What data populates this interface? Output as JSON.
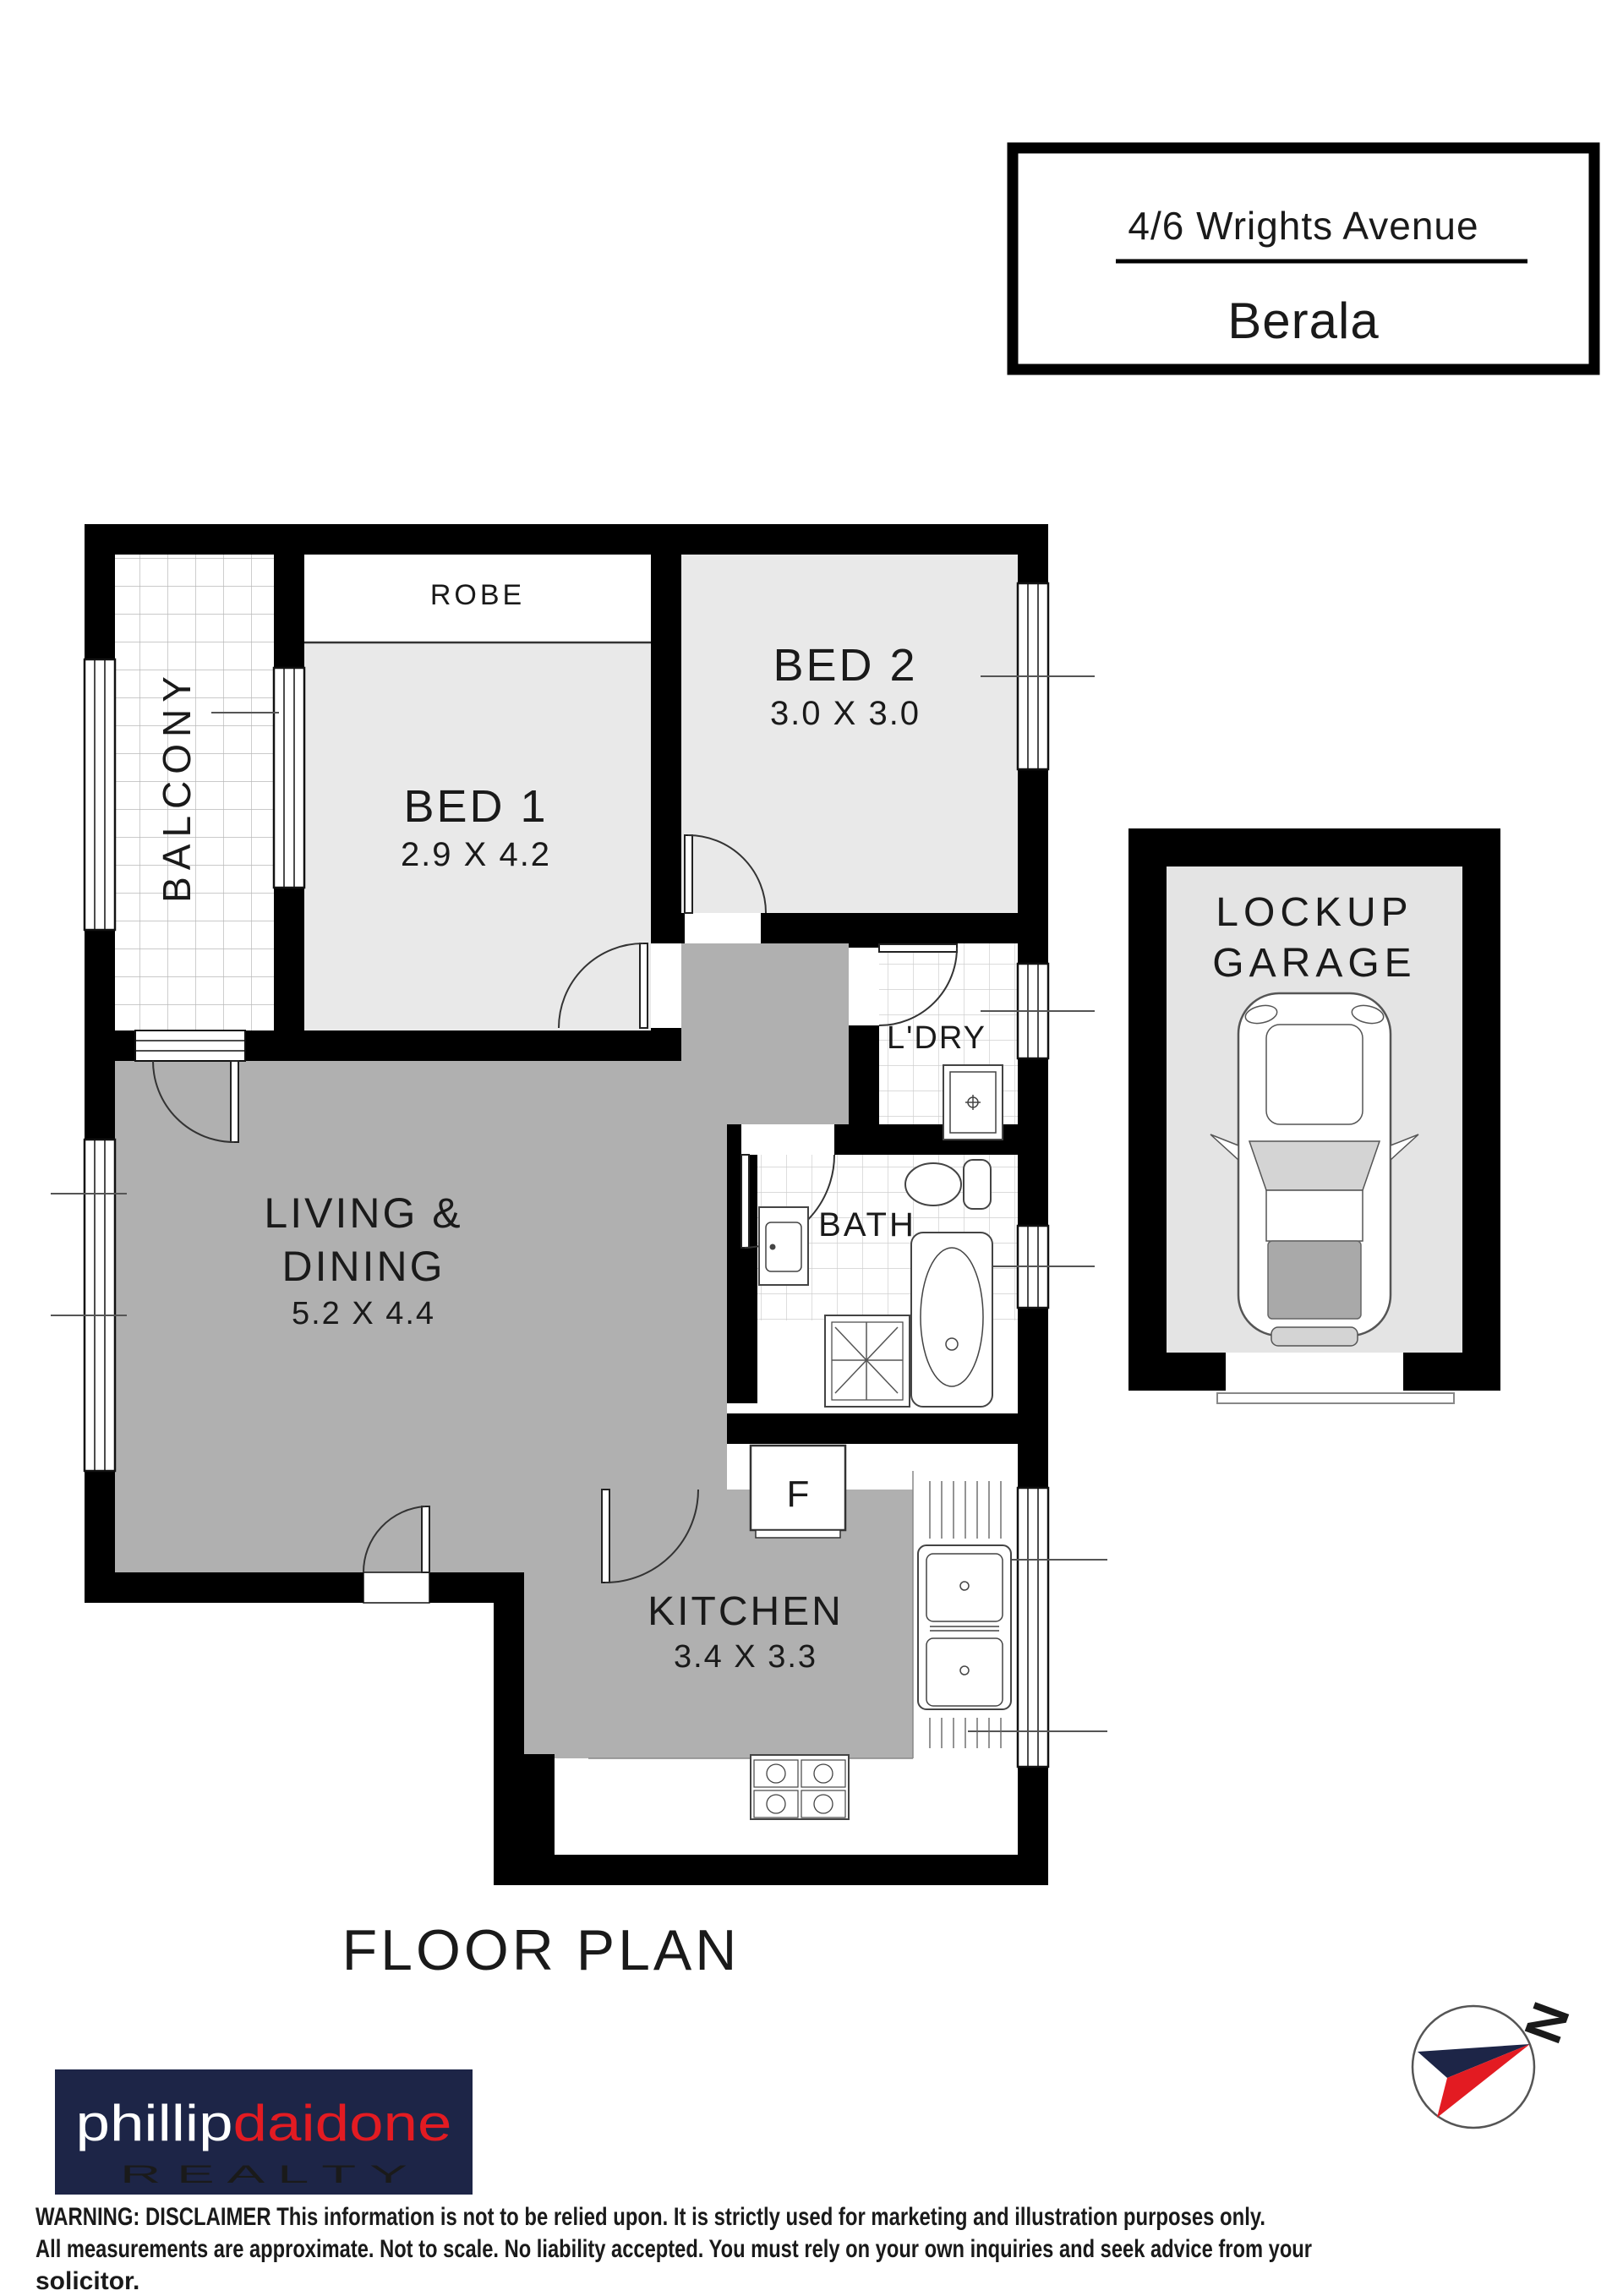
{
  "header": {
    "address_line1": "4/6 Wrights Avenue",
    "suburb": "Berala"
  },
  "plan": {
    "title": "FLOOR PLAN",
    "rooms": {
      "balcony": {
        "label": "BALCONY"
      },
      "robe": {
        "label": "ROBE"
      },
      "bed1": {
        "label": "BED 1",
        "dims": "2.9 X 4.2"
      },
      "bed2": {
        "label": "BED 2",
        "dims": "3.0 X 3.0"
      },
      "laundry": {
        "label": "L'DRY"
      },
      "bath": {
        "label": "BATH"
      },
      "living": {
        "label_line1": "LIVING &",
        "label_line2": "DINING",
        "dims": "5.2 X 4.4"
      },
      "kitchen": {
        "label": "KITCHEN",
        "dims": "3.4 X 3.3"
      },
      "fridge": {
        "label": "F"
      }
    },
    "garage": {
      "label_line1": "LOCKUP",
      "label_line2": "GARAGE"
    }
  },
  "compass": {
    "label": "N"
  },
  "branding": {
    "name_part1": "phillip",
    "name_part2": "daidone",
    "tagline": "R E A L T Y",
    "navy": "#1d2547",
    "red": "#e31b22"
  },
  "footer": {
    "line1": "WARNING: DISCLAIMER This information is not to be relied upon. It is strictly used for marketing and illustration purposes only.",
    "line2": "All measurements are approximate. Not to scale. No liability accepted. You must rely on your own inquiries and seek advice from your",
    "line3": "solicitor."
  },
  "colors": {
    "wall": "#000000",
    "floor_main": "#b0b0b0",
    "floor_bed": "#e9e9e9",
    "floor_garage": "#e4e4e4"
  }
}
